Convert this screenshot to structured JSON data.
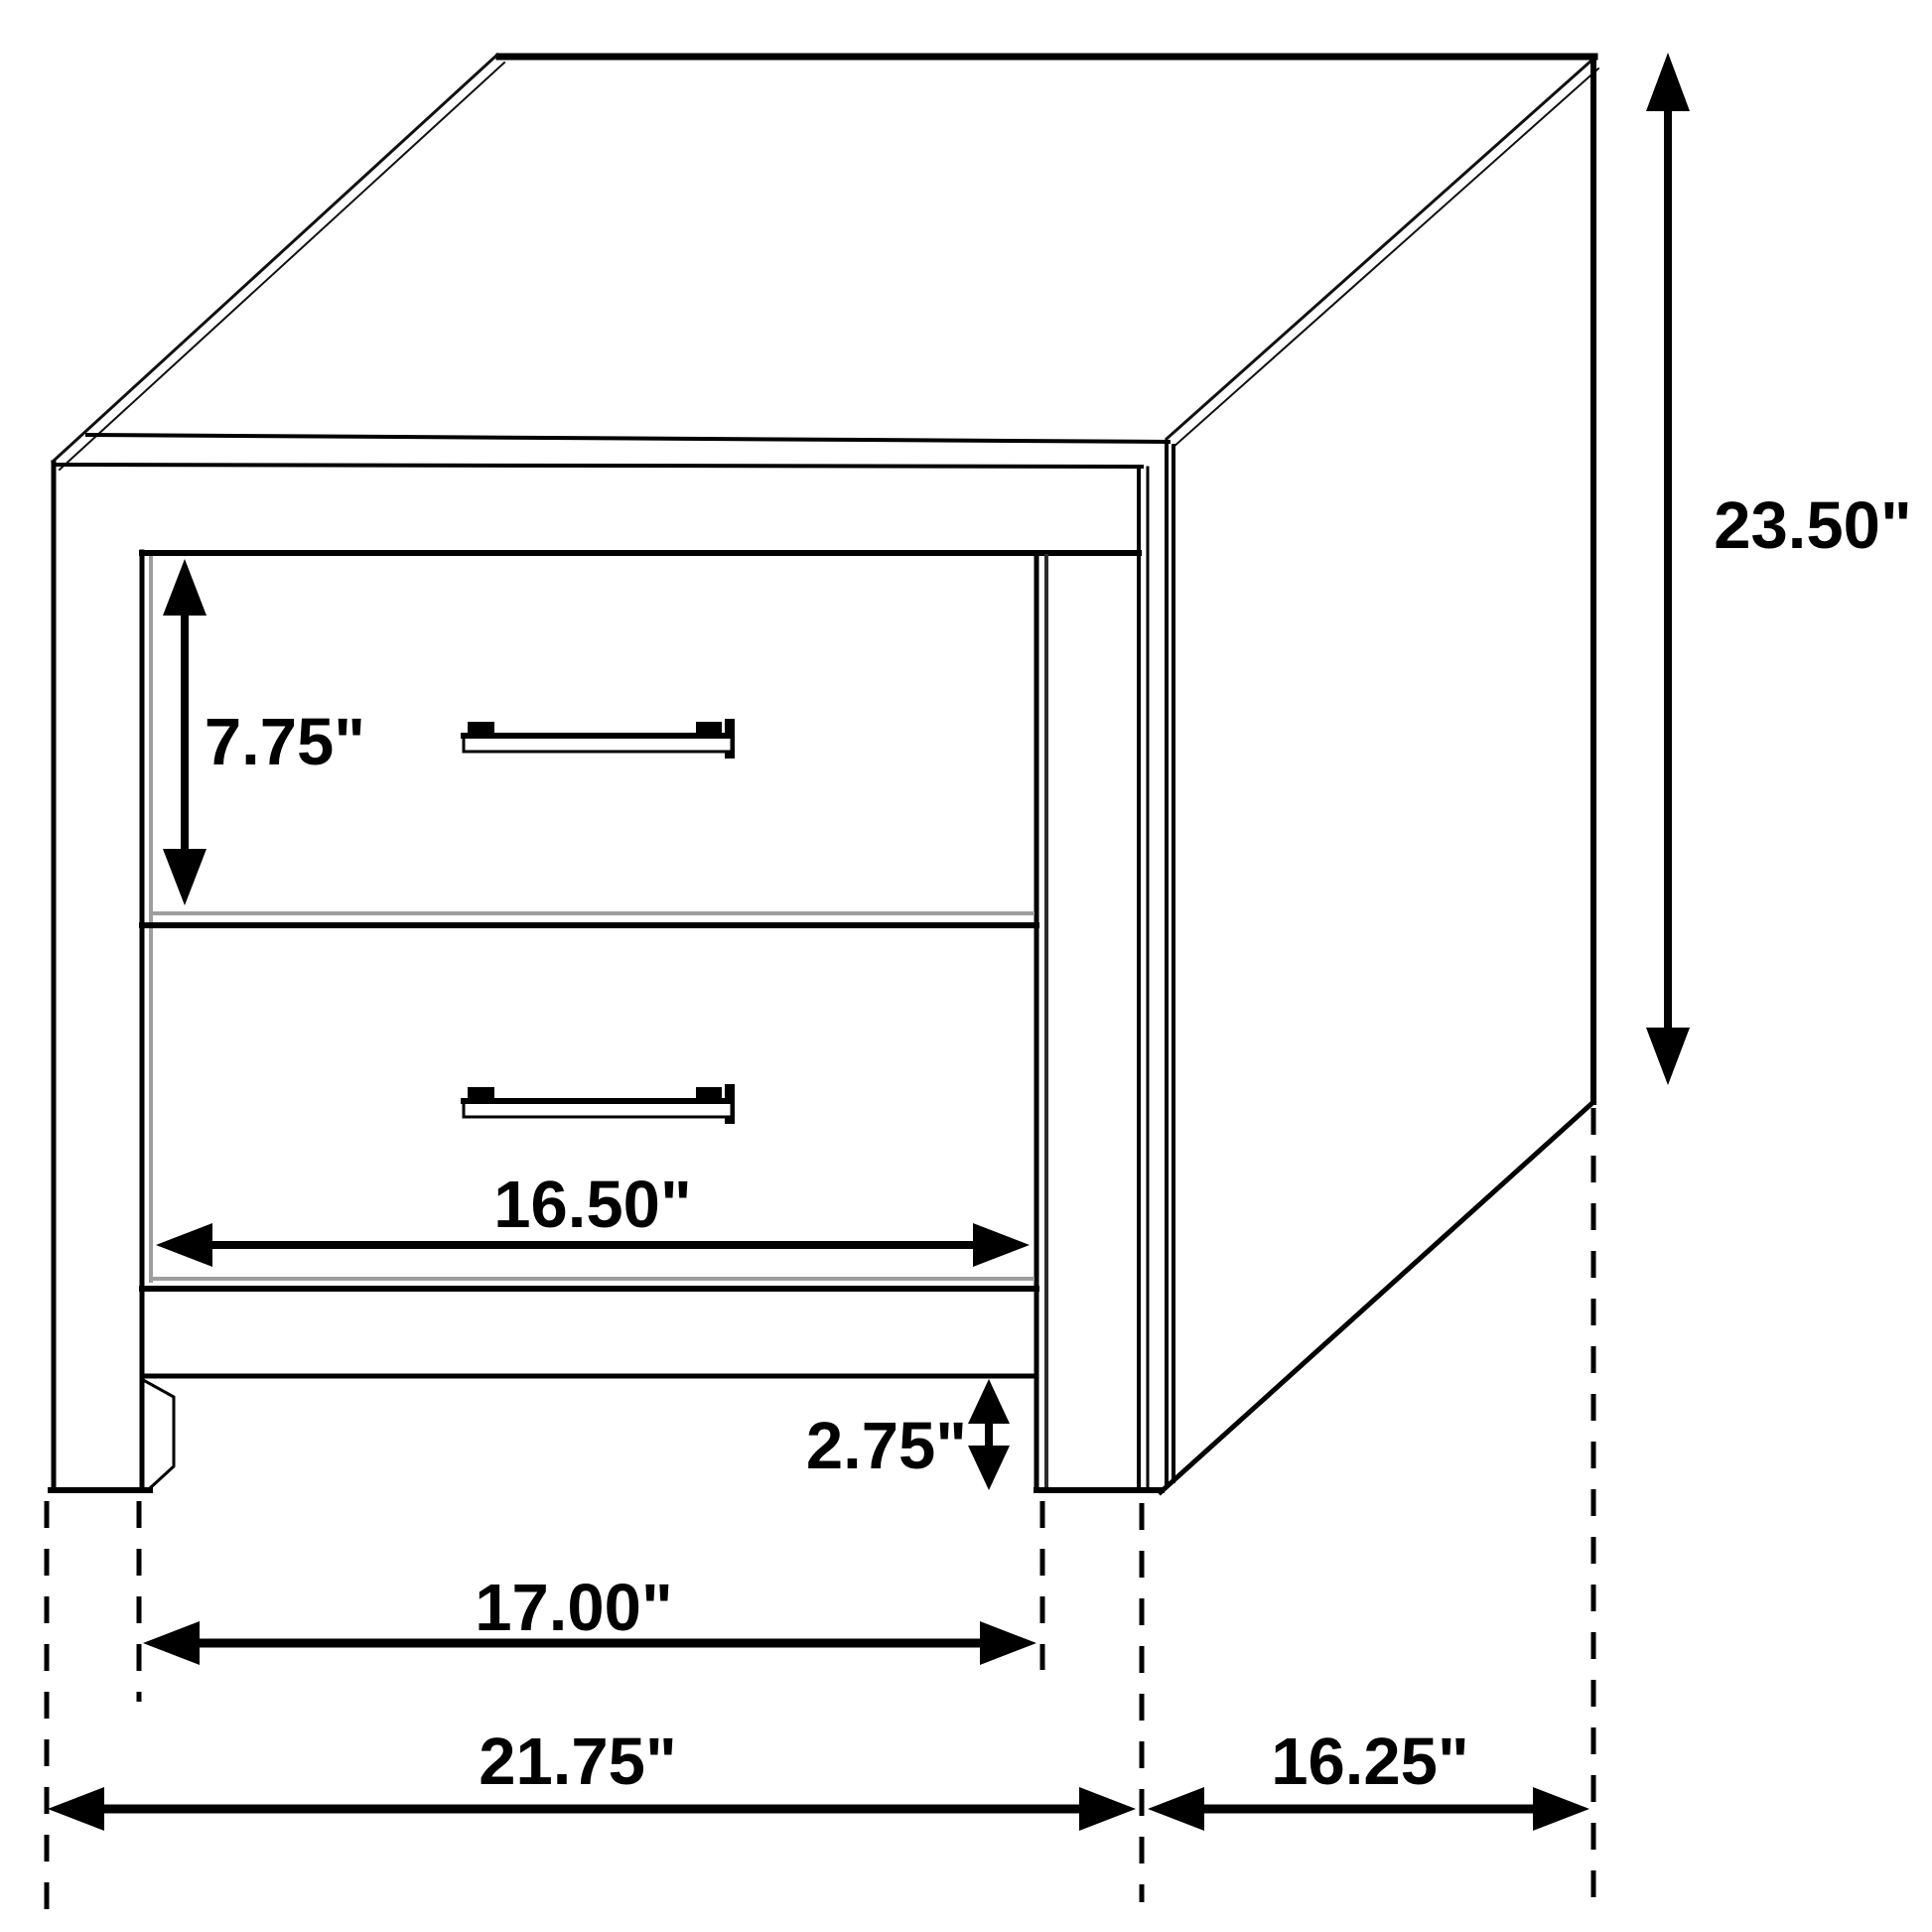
{
  "diagram": {
    "type": "furniture-dimension-drawing",
    "subject": "two-drawer nightstand isometric line drawing",
    "units": "inches",
    "colors": {
      "line": "#000000",
      "shadow": "#9e9e9e",
      "background": "#ffffff"
    },
    "dimensions": {
      "drawer_height": "7.75\"",
      "overall_height": "23.50\"",
      "drawer_width": "16.50\"",
      "leg_clearance": "2.75\"",
      "width_between_legs": "17.00\"",
      "overall_width": "21.75\"",
      "depth": "16.25\""
    }
  }
}
